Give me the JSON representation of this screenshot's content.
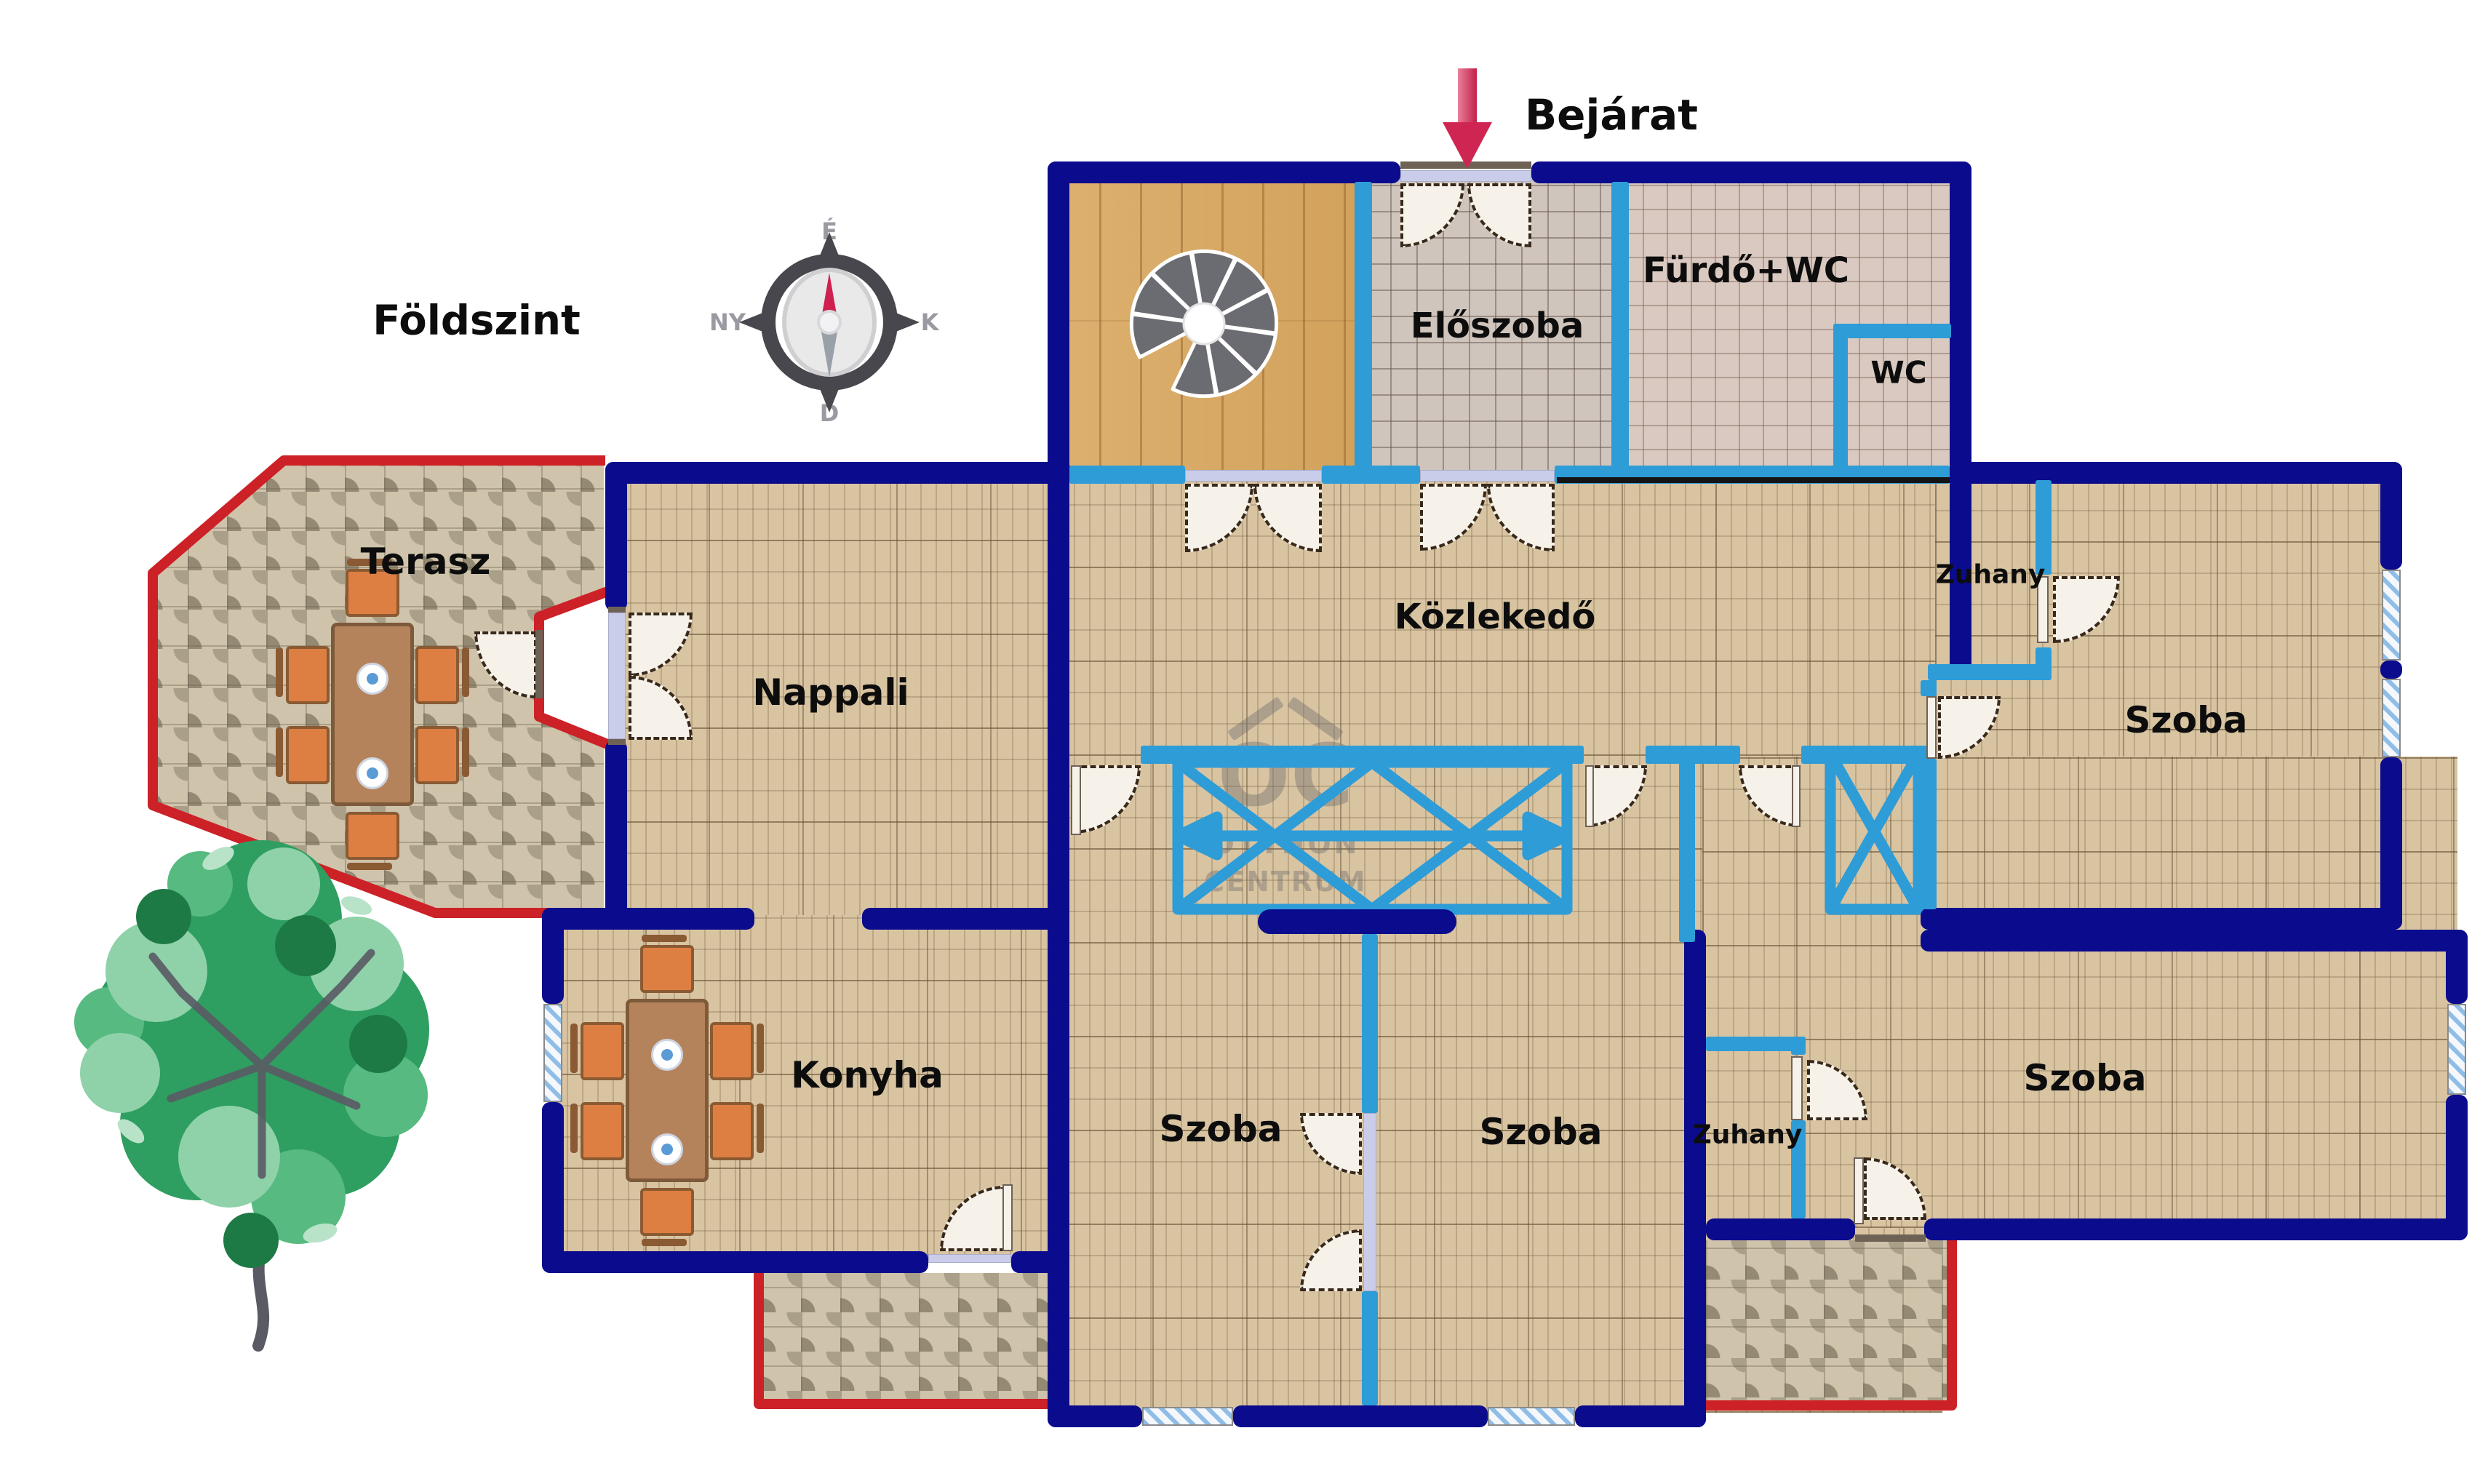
{
  "title": {
    "floor_label": "Földszint",
    "entrance_label": "Bejárat"
  },
  "compass": {
    "north": "É",
    "south": "D",
    "west": "NY",
    "east": "K"
  },
  "watermark": {
    "logo": "OC",
    "line1": "OTTHON",
    "line2": "CENTRUM"
  },
  "rooms": {
    "eloszoba": "Előszoba",
    "furdo_wc": "Fürdő+WC",
    "wc": "WC",
    "kozlekedo": "Közlekedő",
    "nappali": "Nappali",
    "terasz": "Terasz",
    "konyha": "Konyha",
    "szoba": "Szoba",
    "zuhany": "Zuhany"
  },
  "colors": {
    "structural_wall": "#0b0b8d",
    "interior_wall": "#2e9cd7",
    "terrace_border": "#cc2127",
    "entrance_arrow": "#cf2553",
    "floor_tile": "#d9c4a2"
  }
}
